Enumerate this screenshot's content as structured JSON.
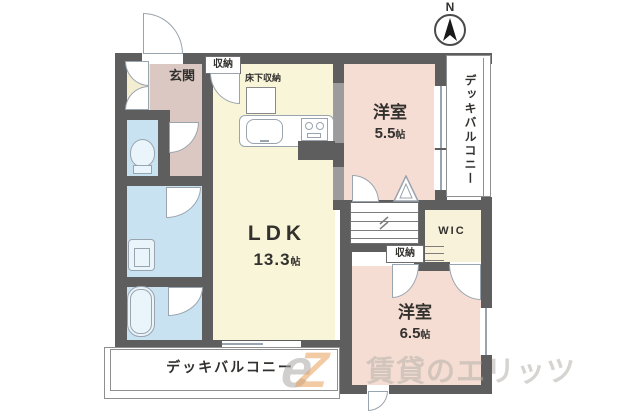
{
  "compass": {
    "label": "N"
  },
  "rooms": {
    "entrance": {
      "label": "玄関"
    },
    "ldk": {
      "label": "LDK",
      "size": "13.3",
      "unit": "帖"
    },
    "bedroom_upper": {
      "label": "洋室",
      "size": "5.5",
      "unit": "帖"
    },
    "bedroom_lower": {
      "label": "洋室",
      "size": "6.5",
      "unit": "帖"
    },
    "wic": {
      "label": "WIC"
    },
    "deck_balcony_right": {
      "label": "デッキバルコニー"
    },
    "deck_balcony_bottom": {
      "label": "デッキバルコニー"
    }
  },
  "storage": {
    "hall_closet": {
      "label": "収納"
    },
    "bedroom_closet": {
      "label": "収納"
    },
    "underfloor": {
      "label": "床下収納"
    }
  },
  "watermark": {
    "logo_gray": "e",
    "logo_accent": "Z",
    "brand_text": "賃貸のエリッツ"
  },
  "colors": {
    "wall": "#5f5e5e",
    "ldk_yellow": "#f9f5d8",
    "bedroom_pink": "#f6ddd3",
    "entrance_mauve": "#dcc8c3",
    "wet_area_blue": "#c9e2f2",
    "wic_cream": "#f8f2da",
    "fixture_outline": "#9aa4ae",
    "watermark_gray": "#beb9b2",
    "watermark_orange": "#e8a36c"
  }
}
